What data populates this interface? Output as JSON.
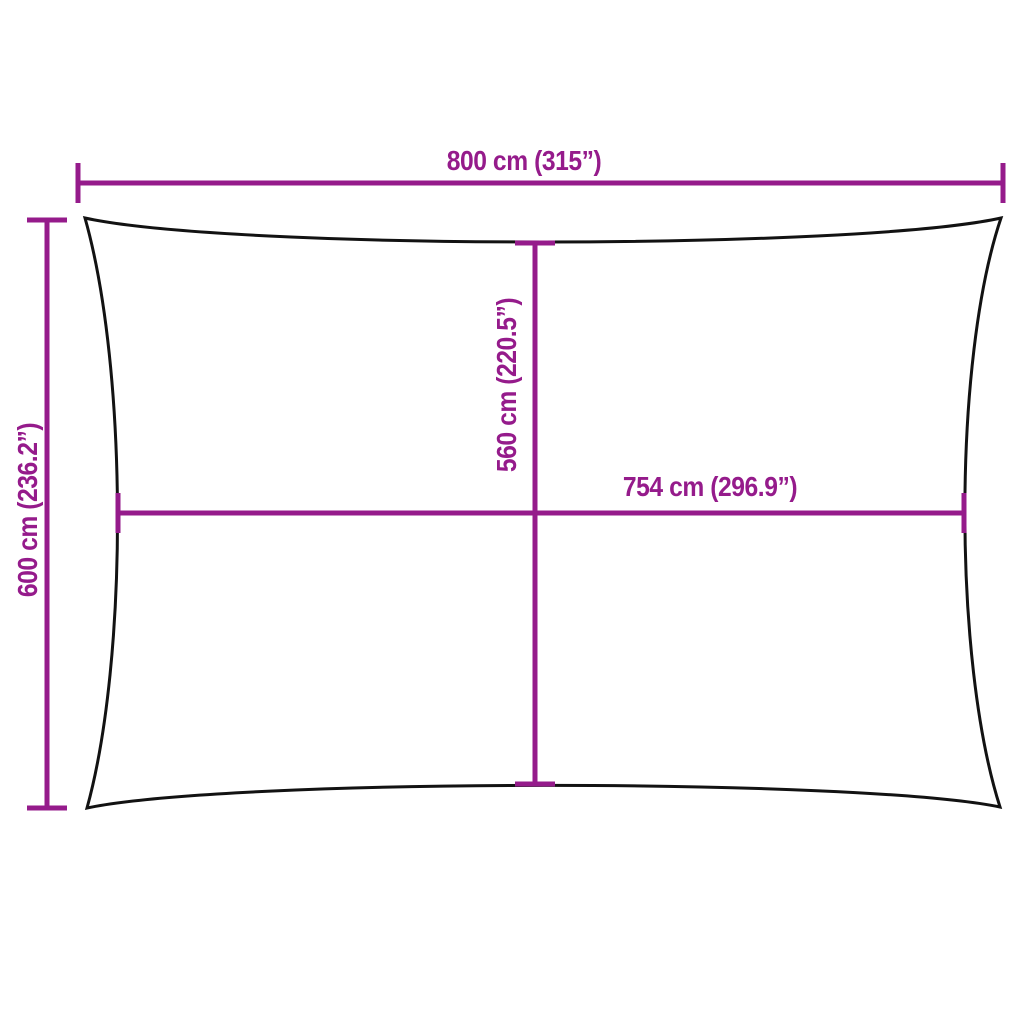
{
  "colors": {
    "accent": "#951b8b",
    "outline": "#121212"
  },
  "diagram": {
    "dimensions": {
      "top_width": {
        "label": "800 cm (315”)",
        "cm": 800,
        "inch": 315,
        "orientation": "horizontal"
      },
      "left_height": {
        "label": "600 cm (236.2”)",
        "cm": 600,
        "inch": 236.2,
        "orientation": "vertical"
      },
      "center_height": {
        "label": "560 cm (220.5”)",
        "cm": 560,
        "inch": 220.5,
        "orientation": "vertical"
      },
      "center_width": {
        "label": "754 cm (296.9”)",
        "cm": 754,
        "inch": 296.9,
        "orientation": "horizontal"
      }
    }
  }
}
